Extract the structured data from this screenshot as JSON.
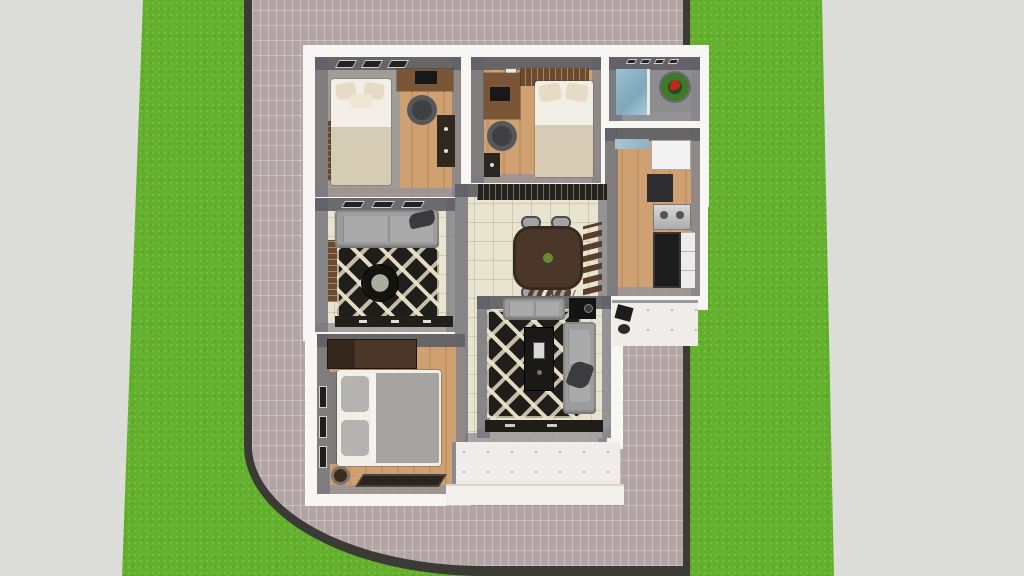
{
  "scene": {
    "type": "3d-floorplan-render",
    "view": "top-down aerial",
    "description": "SketchUp-style 3D render of a small one-storey house floor plan, placed on a brick-paved corner lot bordered by green lawn strips and concrete sidewalks",
    "colors": {
      "ground": "#dcdcd9",
      "grass": "#63b02c",
      "brick": "#b3a4a6",
      "curb": "#3b3a35",
      "wallWhite": "#f7f6f2",
      "wallGray": "#808085",
      "wood": "#cfa172",
      "tile": "#e9e4cf",
      "rug": "#201e1b",
      "sofa": "#9c9c9c",
      "bedLinen": "#f1efe8",
      "bedBlanket": "#d6ccb6",
      "bedGray": "#a6a4a0",
      "tableBrown": "#4b372a",
      "woodBrown": "#6b4a2e",
      "darkFurniture": "#23201c",
      "fridge": "#f2f2f2",
      "steel": "#d9d9d9",
      "bathBlue": "#9cc0cf",
      "plantGreen": "#3f7a28",
      "flowerRed": "#c6251f",
      "porch": "#efecea"
    },
    "ground": {
      "left_sidewalk": "concrete strip, far left",
      "left_lawn": "vertical grass strip",
      "lot_paving": "mauve brick pavers with dark curb and rounded street corner at bottom-left",
      "right_lawn": "vertical grass strip",
      "right_sidewalk": "concrete strip, far right"
    },
    "house": {
      "rooms": [
        {
          "id": "bedroom-1",
          "label": "Bedroom 1",
          "furniture": [
            "double bed with cream bedding",
            "three pillows",
            "desk with monitor",
            "office chair",
            "dark dresser",
            "closet",
            "three top-wall windows"
          ]
        },
        {
          "id": "bedroom-2",
          "label": "Bedroom 2",
          "furniture": [
            "single bed with cream bedding",
            "desk with monitor",
            "office chair",
            "brown wardrobe",
            "dark cabinet"
          ]
        },
        {
          "id": "bathroom",
          "label": "Bathroom",
          "furniture": [
            "blue tiled shower",
            "potted plant with red flowers",
            "vent windows"
          ]
        },
        {
          "id": "kitchen",
          "label": "Kitchen",
          "furniture": [
            "refrigerator",
            "tall unit",
            "stainless stove",
            "black counter",
            "white cabinets",
            "window"
          ]
        },
        {
          "id": "living-room",
          "label": "Living Room",
          "furniture": [
            "gray sofa",
            "cat on sofa",
            "black & white lattice rug",
            "round coffee table",
            "dark media console",
            "louvered side window"
          ]
        },
        {
          "id": "dining-area",
          "label": "Dining Area",
          "furniture": [
            "oval dark-wood dining table",
            "four chairs",
            "plant centerpiece",
            "brown louver divider",
            "shoe rack"
          ]
        },
        {
          "id": "family-room",
          "label": "TV Room",
          "furniture": [
            "L-shaped gray sofa",
            "cat on sofa",
            "black & white diagonal rug",
            "dark media unit",
            "black speaker",
            "rear counter"
          ]
        },
        {
          "id": "master-bedroom",
          "label": "Master Bedroom",
          "furniture": [
            "double bed with gray blanket",
            "dark brown wardrobe",
            "headboard",
            "three left-wall windows",
            "round pouf",
            "dark floor rug"
          ]
        },
        {
          "id": "hall-closet",
          "label": "Hallway Closet",
          "furniture": [
            "built-in dark wardrobe"
          ]
        },
        {
          "id": "terrace",
          "label": "Front Terrace",
          "furniture": [
            "white tiled porch",
            "entry step"
          ]
        },
        {
          "id": "side-walkway",
          "label": "Side Walkway",
          "furniture": [
            "white tiled path",
            "equipment items"
          ]
        }
      ]
    }
  }
}
